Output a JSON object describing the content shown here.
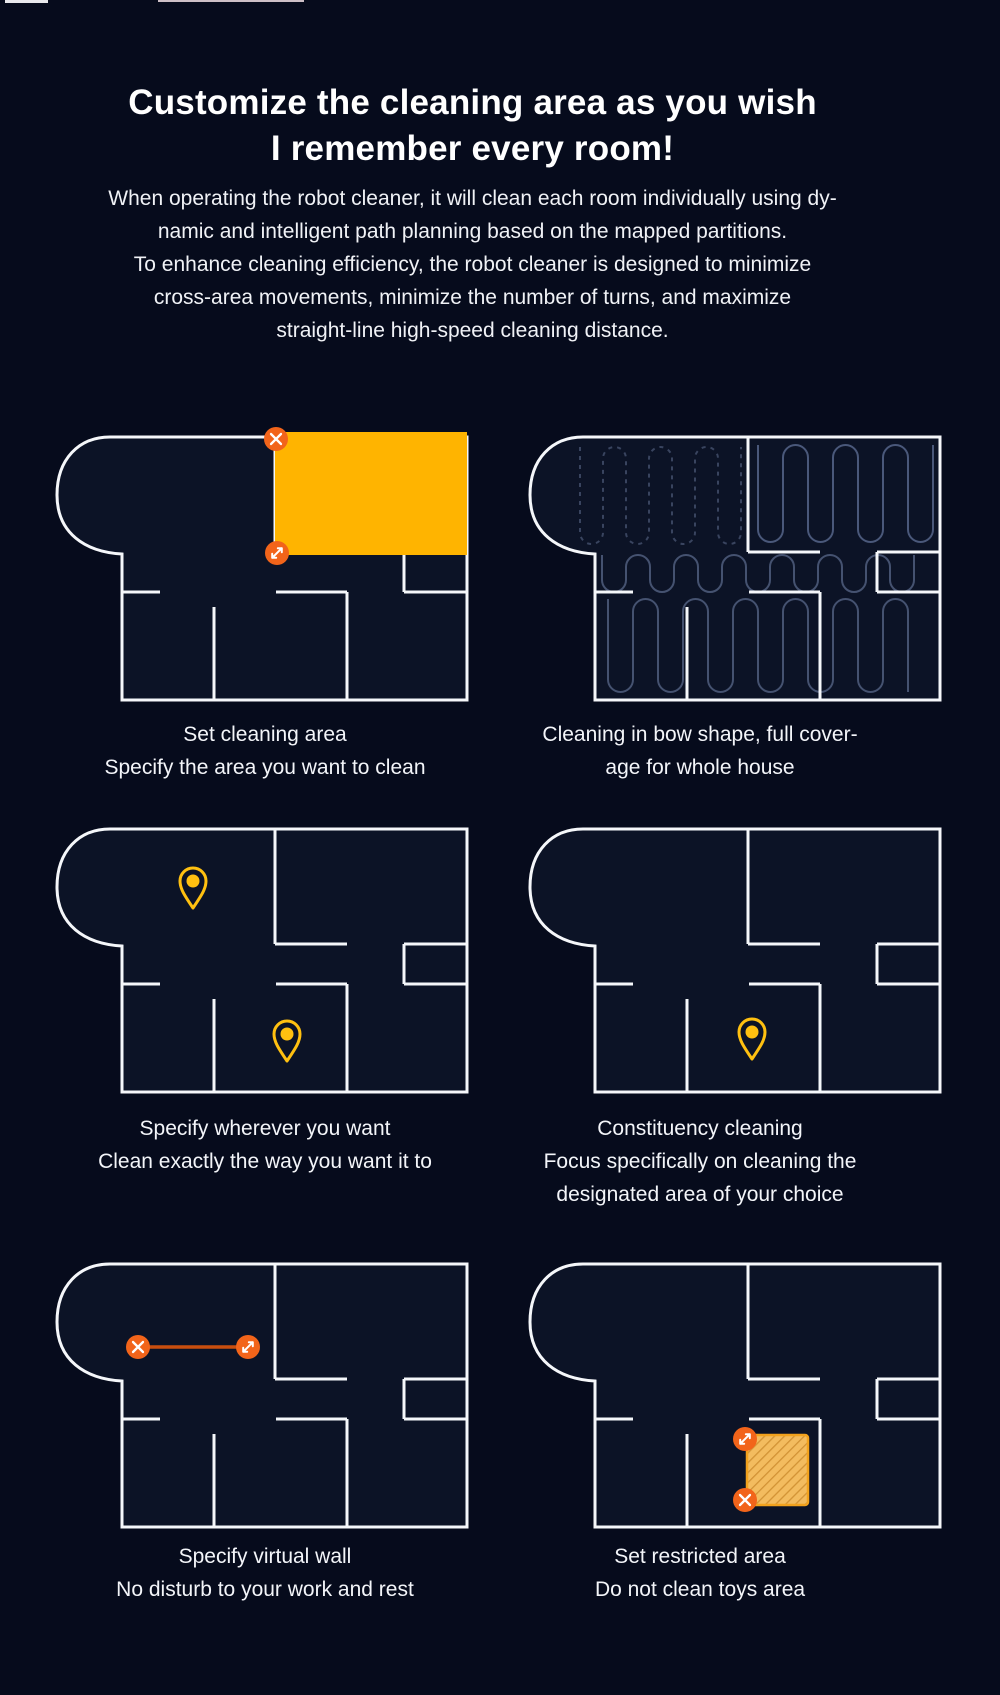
{
  "header": {
    "title_line1": "Customize the cleaning area as you wish",
    "title_line2": "I remember every room!"
  },
  "intro": {
    "lines": [
      "When operating the robot cleaner, it will clean each room individually using dy-",
      "namic and intelligent path planning based on the mapped partitions.",
      "To enhance cleaning efficiency, the robot cleaner is designed to minimize",
      "cross-area movements, minimize the number of turns, and maximize",
      "straight-line high-speed cleaning distance."
    ]
  },
  "features": [
    {
      "name": "set-cleaning-area",
      "caption": [
        "Set cleaning area",
        "Specify the area you want to clean"
      ]
    },
    {
      "name": "bow-shape-cleaning",
      "caption": [
        "Cleaning in bow shape, full cover-",
        "age for whole house"
      ]
    },
    {
      "name": "specify-wherever",
      "caption": [
        "Specify wherever you want",
        "Clean exactly the way you want it to"
      ]
    },
    {
      "name": "constituency-cleaning",
      "caption": [
        "Constituency cleaning",
        "Focus specifically on cleaning the",
        "designated area of your choice"
      ]
    },
    {
      "name": "virtual-wall",
      "caption": [
        "Specify virtual wall",
        "No disturb to your work and rest"
      ]
    },
    {
      "name": "restricted-area",
      "caption": [
        "Set restricted area",
        "Do not clean toys area"
      ]
    }
  ],
  "icons": {
    "close": "x-icon",
    "resize": "diagonal-resize-icon",
    "pin": "location-pin-icon"
  },
  "colors": {
    "background": "#060b1c",
    "floorplan_fill": "#0c1326",
    "wall_white": "#f5f7fa",
    "accent_yellow": "#ffb400",
    "accent_orange": "#f2641a",
    "virtual_wall_line": "#c94e0e",
    "pin_amber": "#ffc010",
    "cleaning_path_solid": "#4a587a",
    "cleaning_path_dashed": "#39445f",
    "restricted_fill": "#f3bc5f",
    "restricted_hatch": "#d29335",
    "restricted_border": "#f2a21d"
  }
}
